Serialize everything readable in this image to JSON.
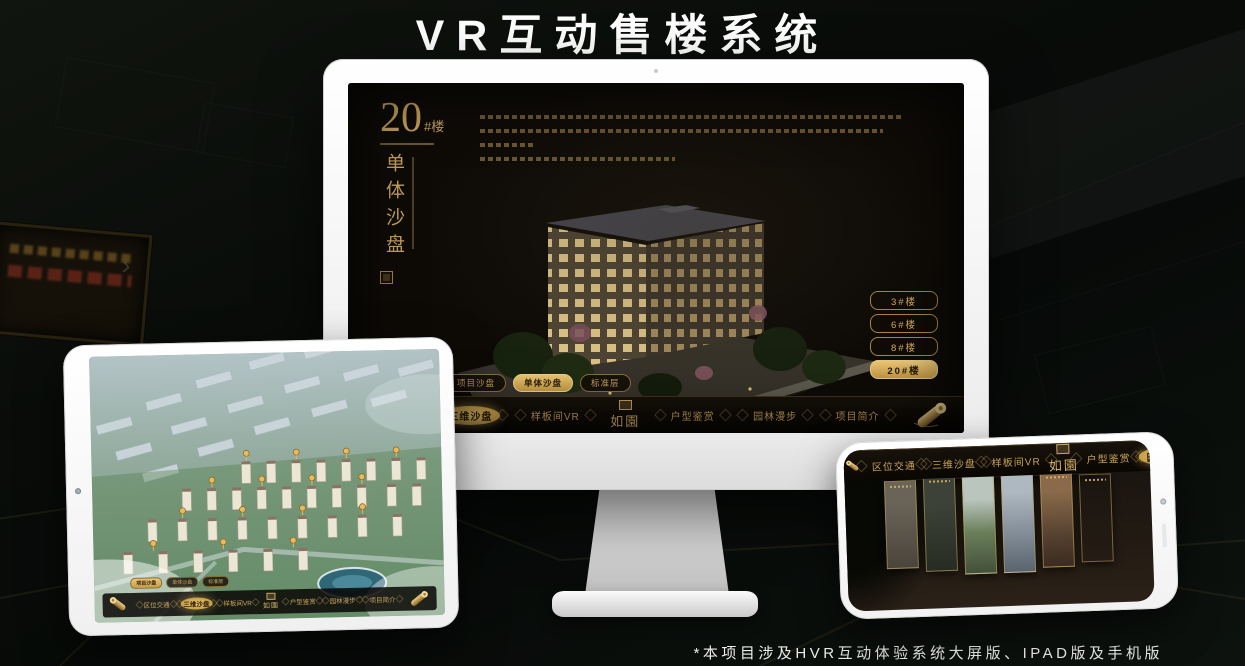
{
  "header": {
    "title": "VR互动售楼系统"
  },
  "footer": {
    "note": "*本项目涉及HVR互动体验系统大屏版、IPAD版及手机版"
  },
  "ui": {
    "building_no": "20",
    "building_unit": "#楼",
    "building_mode": "单体沙盘",
    "logo": "如園",
    "view_tabs": [
      "项目沙盘",
      "单体沙盘",
      "标准层"
    ],
    "floor_buttons": [
      "3#楼",
      "6#楼",
      "8#楼",
      "20#楼"
    ],
    "nav_items": [
      "区位交通",
      "三维沙盘",
      "样板间VR",
      "户型鉴赏",
      "园林漫步",
      "项目简介"
    ]
  },
  "colors": {
    "gold": "#c9a35c",
    "gold_active": "#e3bb63",
    "screen_bg": "#0e0b07",
    "page_bg": "#0a0d0a"
  }
}
